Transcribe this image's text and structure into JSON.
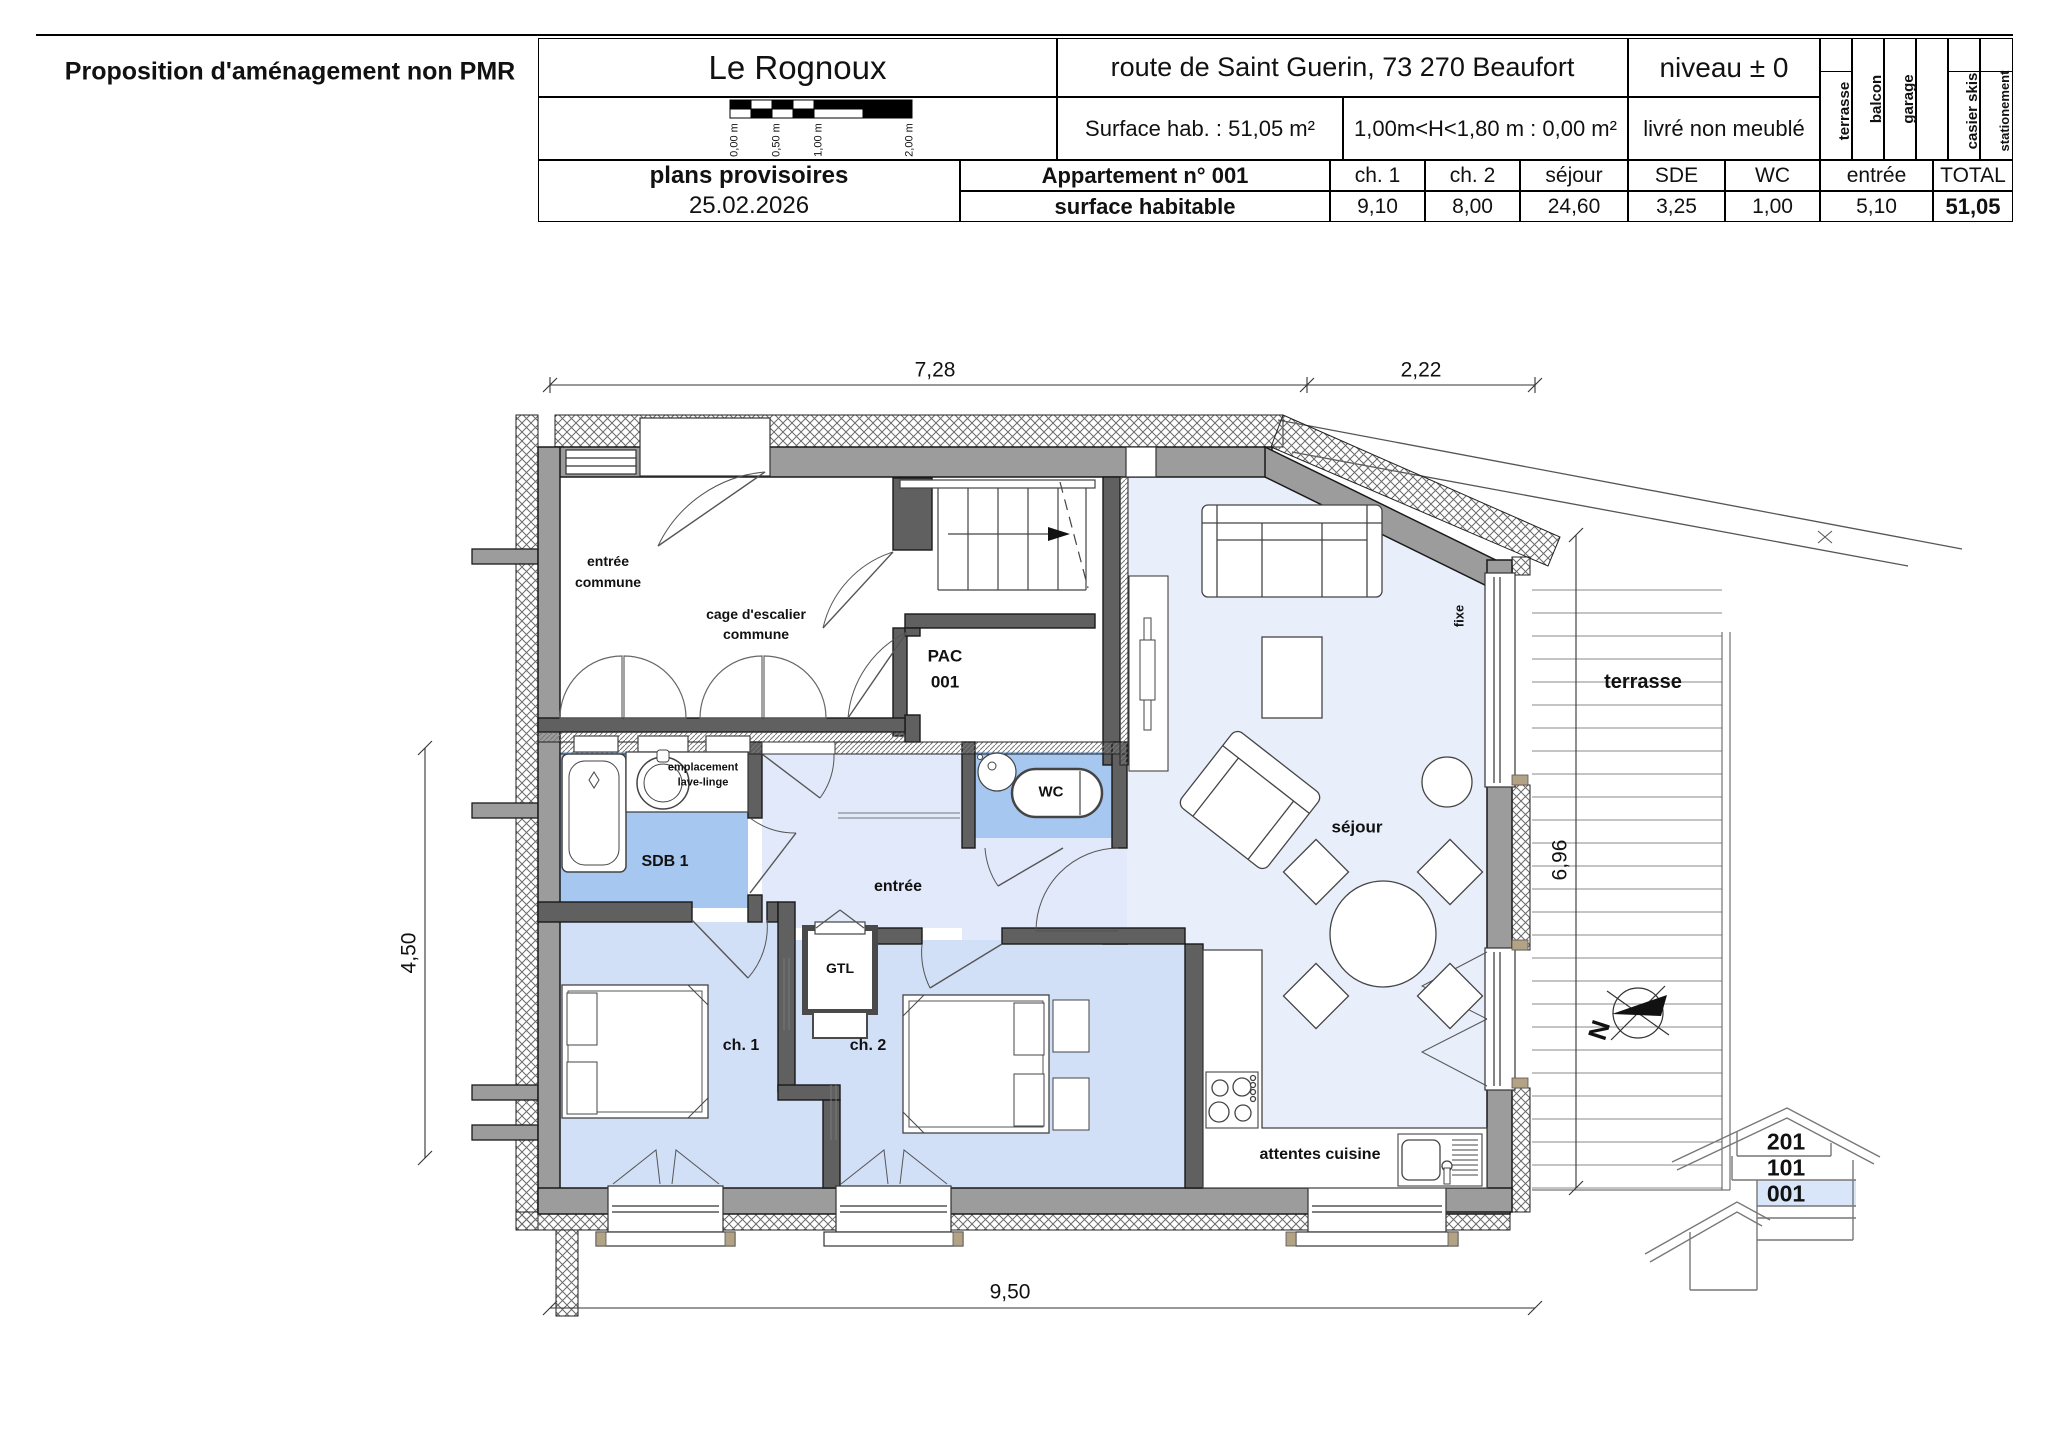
{
  "header": {
    "proposal": "Proposition d'aménagement non PMR",
    "project": "Le Rognoux",
    "address": "route de Saint Guerin,  73 270 Beaufort",
    "level": "niveau ± 0",
    "surface": "Surface hab. :  51,05 m²",
    "height_rule": "1,00m<H<1,80 m : 0,00 m²",
    "delivery": "livré non meublé",
    "status": "plans provisoires",
    "date": "25.02.2026",
    "scale_ticks": [
      "0,00 m",
      "0,50 m",
      "1,00 m",
      "2,00 m"
    ],
    "amenities": [
      "terrasse",
      "balcon",
      "garage",
      "",
      "casier skis",
      "stationement"
    ],
    "table": {
      "apartment": "Appartement n° 001",
      "row_label": "surface habitable",
      "columns": [
        "ch. 1",
        "ch. 2",
        "séjour",
        "SDE",
        "WC",
        "entrée",
        "TOTAL"
      ],
      "values": [
        "9,10",
        "8,00",
        "24,60",
        "3,25",
        "1,00",
        "5,10",
        "51,05"
      ]
    }
  },
  "plan": {
    "rooms": {
      "entree_commune": [
        "entrée",
        "commune"
      ],
      "cage": [
        "cage d'escalier",
        "commune"
      ],
      "pac": [
        "PAC",
        "001"
      ],
      "lave": [
        "emplacement",
        "lave-linge"
      ],
      "sdb": "SDB 1",
      "wc": "WC",
      "entree": "entrée",
      "gtl": "GTL",
      "ch1": "ch. 1",
      "ch2": "ch. 2",
      "sejour": "séjour",
      "terrasse": "terrasse",
      "attentes": "attentes cuisine",
      "fixe": "fixe"
    },
    "dims": {
      "top_main": "7,28",
      "top_right": "2,22",
      "left": "4,50",
      "right": "6,96",
      "bottom": "9,50"
    },
    "north": "N",
    "section_levels": [
      "201",
      "101",
      "001"
    ]
  },
  "colors": {
    "wall_gray": "#9c9c9c",
    "partition": "#606060",
    "floor_living": "#e9eefb",
    "floor_hall": "#e1e9fa",
    "floor_bedroom": "#d2e0f7",
    "floor_wet": "#a6c7f0",
    "section_highlight": "#d9e6f9",
    "cap_tan": "#b3a284"
  }
}
